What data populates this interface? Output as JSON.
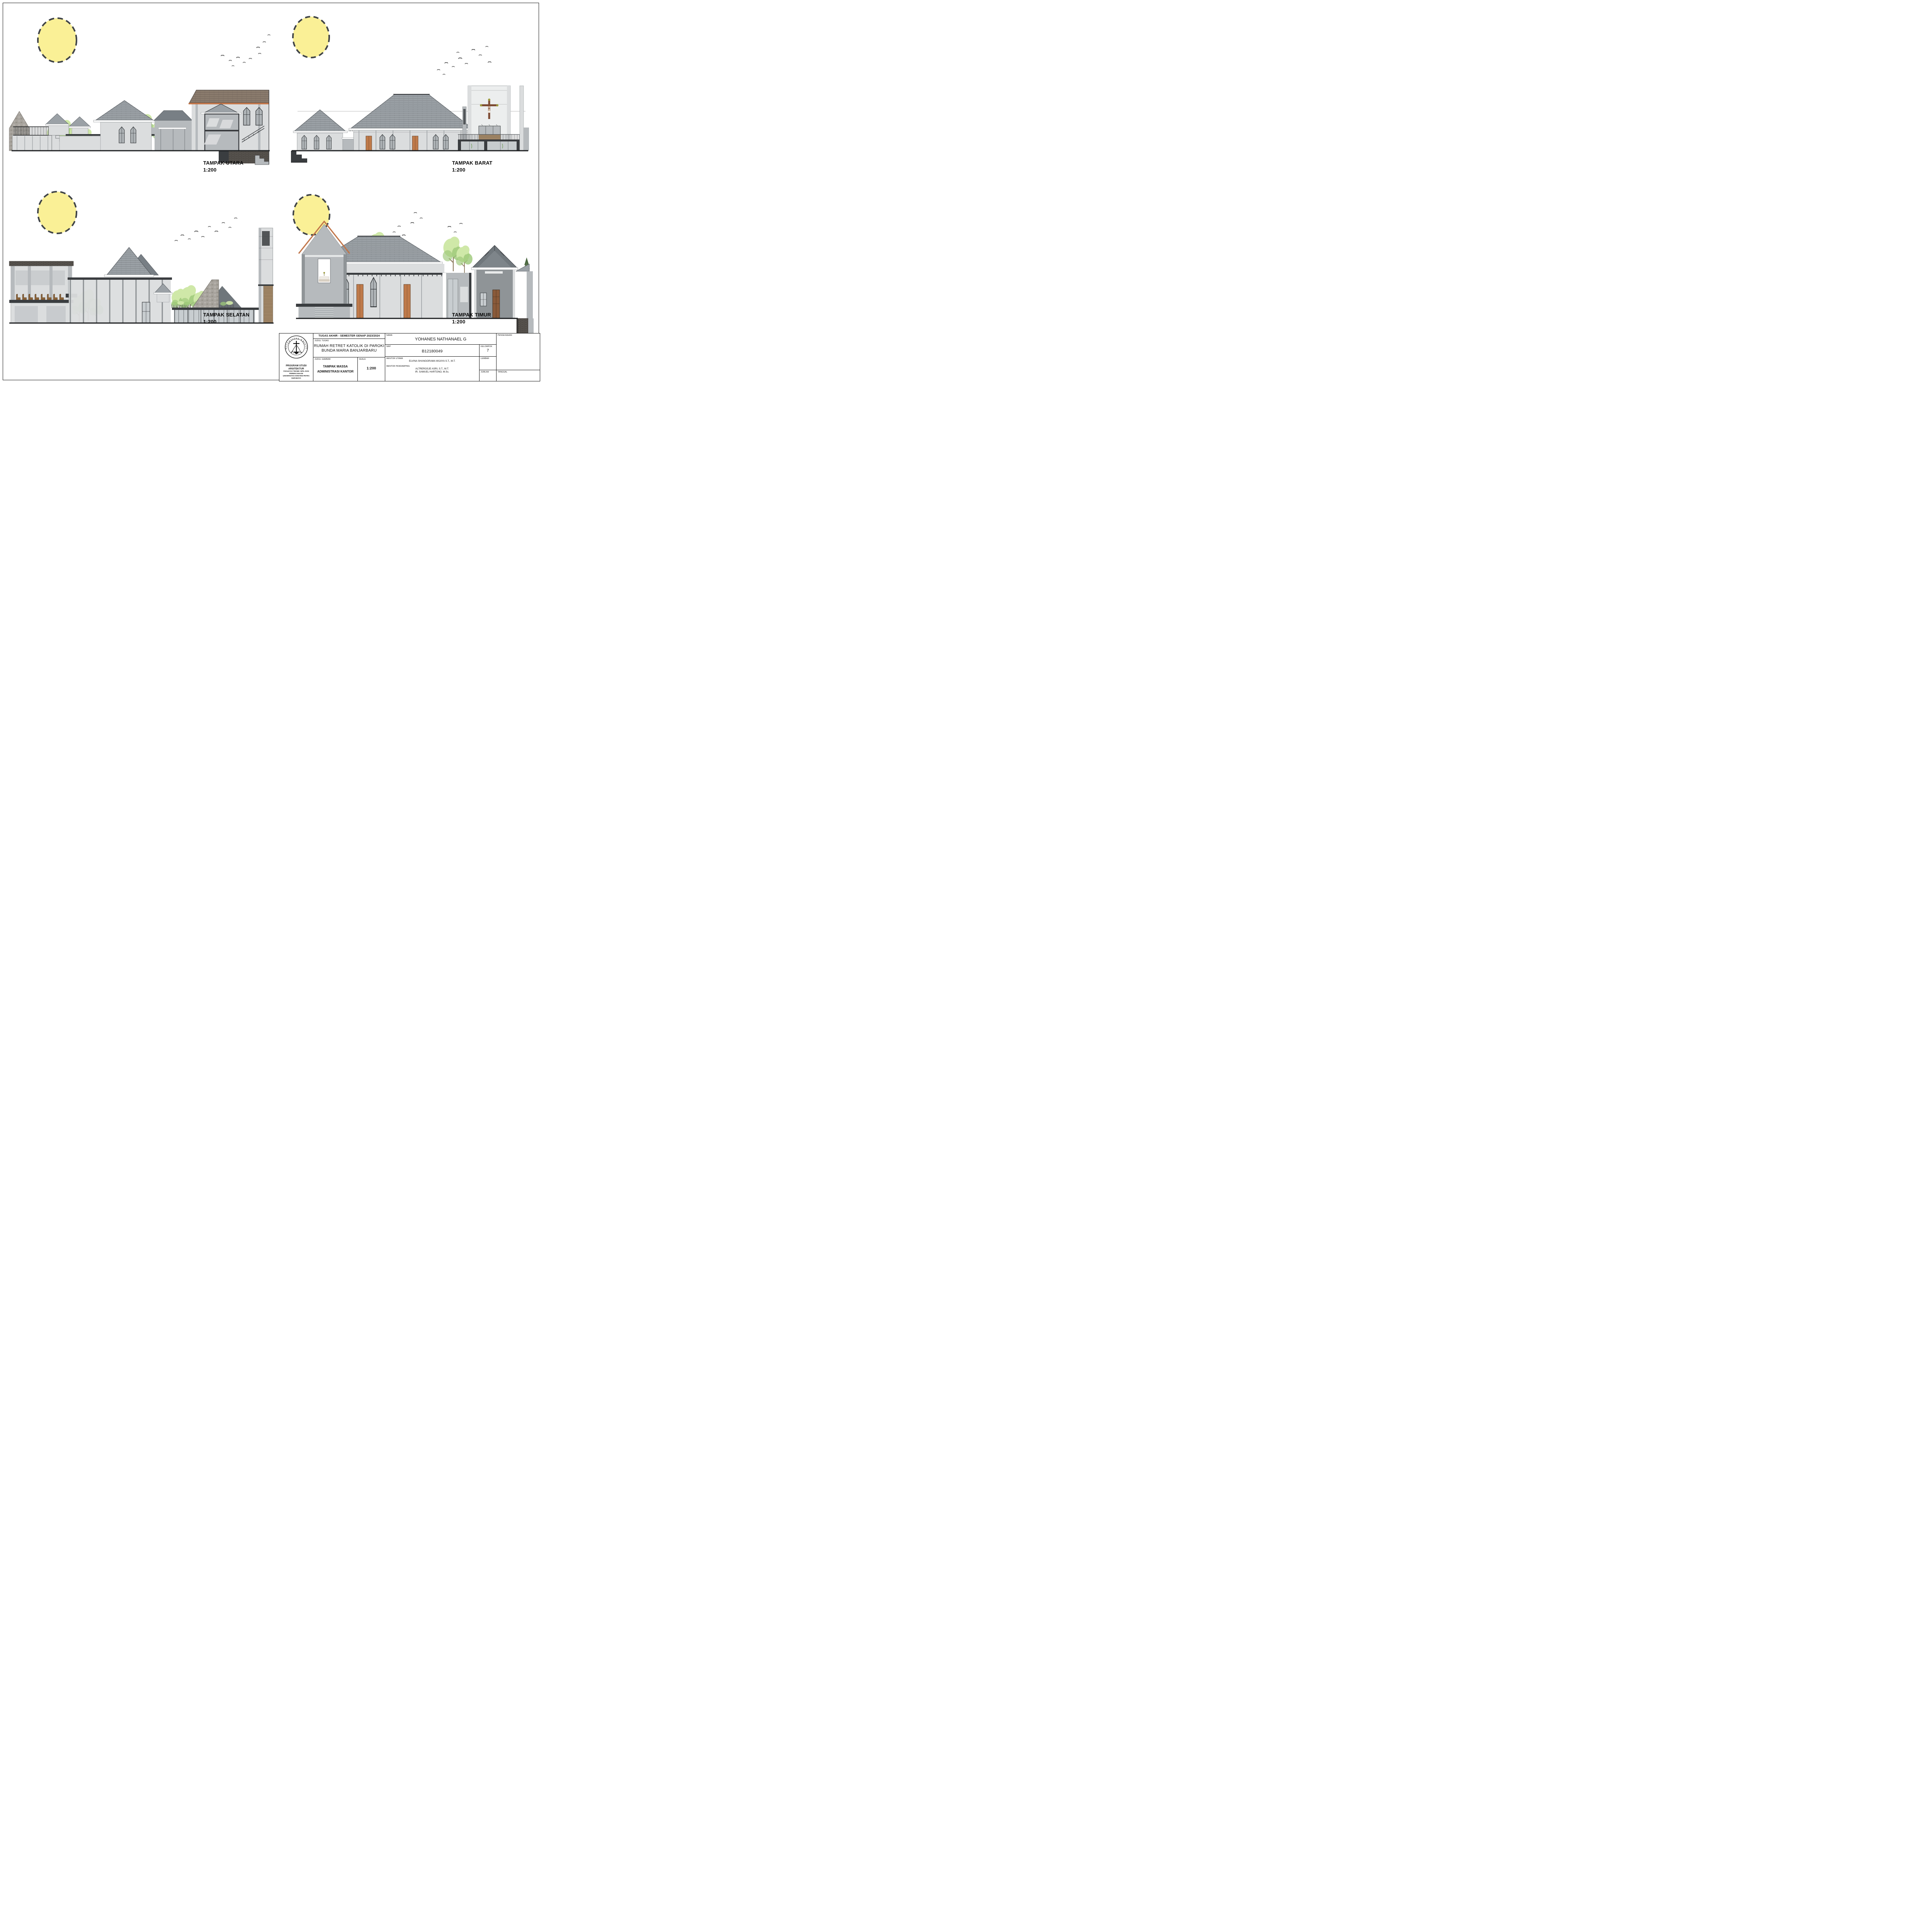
{
  "sheet": {
    "panels": [
      {
        "id": "utara",
        "label": "TAMPAK UTARA",
        "scale": "1:200"
      },
      {
        "id": "barat",
        "label": "TAMPAK BARAT",
        "scale": "1:200"
      },
      {
        "id": "selatan",
        "label": "TAMPAK SELATAN",
        "scale": "1:200"
      },
      {
        "id": "timur",
        "label": "TAMPAK TIMUR",
        "scale": "1:200"
      }
    ]
  },
  "title_block": {
    "header": "TUGAS AKHIR - SEMESTER GENAP 2023/2024",
    "labels": {
      "judul_tugas": "JUDUL TUGAS",
      "judul_gambar": "JUDUL GAMBAR",
      "skala": "SKALA",
      "nama": "NAMA",
      "nrp": "NRP",
      "kelompok": "KELOMPOK",
      "mentor_utama": "MENTOR UTAMA",
      "mentor_pendamping": "MENTOR PENDAMPING",
      "lembar": "LEMBAR",
      "jumlah": "JUMLAH",
      "pengesahan": "PENGESAHAN",
      "tanggal": "TANGGAL"
    },
    "judul_tugas_line1": "RUMAH RETRET KATOLIK DI PAROKI",
    "judul_tugas_line2": "BUNDA MARIA BANJARBARU",
    "judul_gambar_line1": "TAMPAK MASSA",
    "judul_gambar_line2": "ADMINISTRASI KANTOR",
    "skala_value": "1:200",
    "nama_value": "YOHANES NATHANAEL G",
    "nrp_value": "B12180049",
    "kelompok_value": "7",
    "mentor_utama_value": "ELVINA SHANGGRAMA WIJAYA S.T., M.T.",
    "mentor_pendamping_line1": "ALTREROSJE ASRI, S.T., M.T.",
    "mentor_pendamping_line2": "IR. SAMUEL HARTONO, M.Sc.",
    "institution": {
      "line1": "PROGRAM STUDI ARSITEKTUR",
      "line2": "FAKULTAS TEKNIK SIPIL DAN PERENCANAAN",
      "line3": "UNIVERSITAS KRISTEN PETRA",
      "line4": "SURABAYA"
    },
    "logo": {
      "top_text": "UNIVERSITAS KRISTEN",
      "bottom_text": "PETRA"
    }
  },
  "colors": {
    "sun_fill": "#FAF096",
    "sun_stroke": "#3F4347",
    "accent_orange": "#C1764A",
    "roof_gray": "#9BA1A6",
    "roof_dark": "#787F85",
    "roof_brown": "#8A7B6D",
    "wall_light": "#DBDDDE",
    "wall_mid": "#B6BABD",
    "wall_dark": "#8F9497",
    "section_dark": "#3A3D40",
    "glass": "#C8CDD0",
    "door_orange": "#BF7A4A",
    "tree_light": "#CFE8A8",
    "tree_mid": "#9CC878",
    "wood": "#A88D6D",
    "brick": "#5D5954",
    "stone": "#A8A49E",
    "bird": "#1B1B1B"
  }
}
